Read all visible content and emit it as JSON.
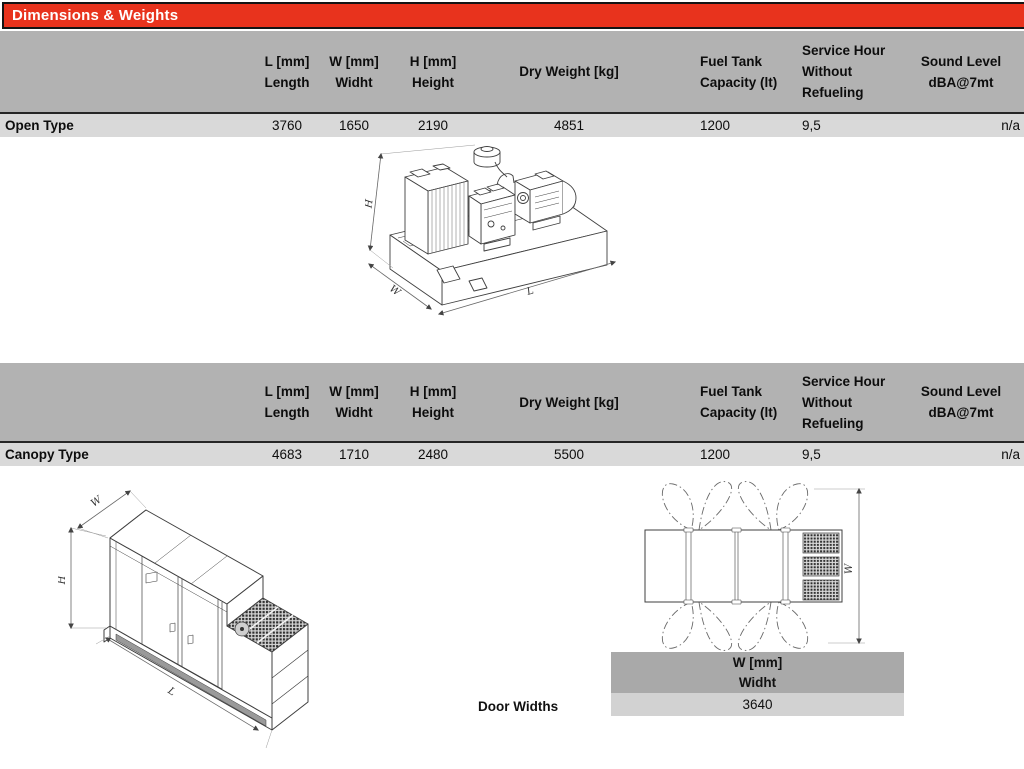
{
  "title": "Dimensions & Weights",
  "colors": {
    "accent_red": "#e8331d",
    "table_header_gray": "#b2b2b2",
    "table_row_gray": "#d9d9d9",
    "mini_header_gray": "#a9a9a9",
    "mini_row_gray": "#d2d2d2"
  },
  "columns": {
    "length": {
      "line1": "L [mm]",
      "line2": "Length"
    },
    "width": {
      "line1": "W [mm]",
      "line2": "Widht"
    },
    "height": {
      "line1": "H [mm]",
      "line2": "Height"
    },
    "dry_weight": {
      "line1": "Dry Weight [kg]"
    },
    "fuel_tank": {
      "line1": "Fuel Tank",
      "line2": "Capacity (lt)"
    },
    "service_hour": {
      "line1": "Service Hour",
      "line2": "Without",
      "line3": "Refueling"
    },
    "sound_level": {
      "line1": "Sound Level",
      "line2": "dBA@7mt"
    }
  },
  "rows": {
    "open": {
      "label": "Open Type",
      "length": "3760",
      "width": "1650",
      "height": "2190",
      "dry_weight": "4851",
      "fuel_tank": "1200",
      "service_hour": "9,5",
      "sound_level": "n/a"
    },
    "canopy": {
      "label": "Canopy Type",
      "length": "4683",
      "width": "1710",
      "height": "2480",
      "dry_weight": "5500",
      "fuel_tank": "1200",
      "service_hour": "9,5",
      "sound_level": "n/a"
    }
  },
  "door_widths": {
    "label": "Door Widths",
    "col_line1": "W [mm]",
    "col_line2": "Widht",
    "value": "3640"
  },
  "drawings": {
    "open_iso": {
      "dim_h": "H",
      "dim_l": "L",
      "dim_w": "W"
    },
    "canopy_iso": {
      "dim_h": "H",
      "dim_l": "L",
      "dim_w": "W"
    },
    "door_top_view": {
      "dim_w": "W"
    }
  }
}
